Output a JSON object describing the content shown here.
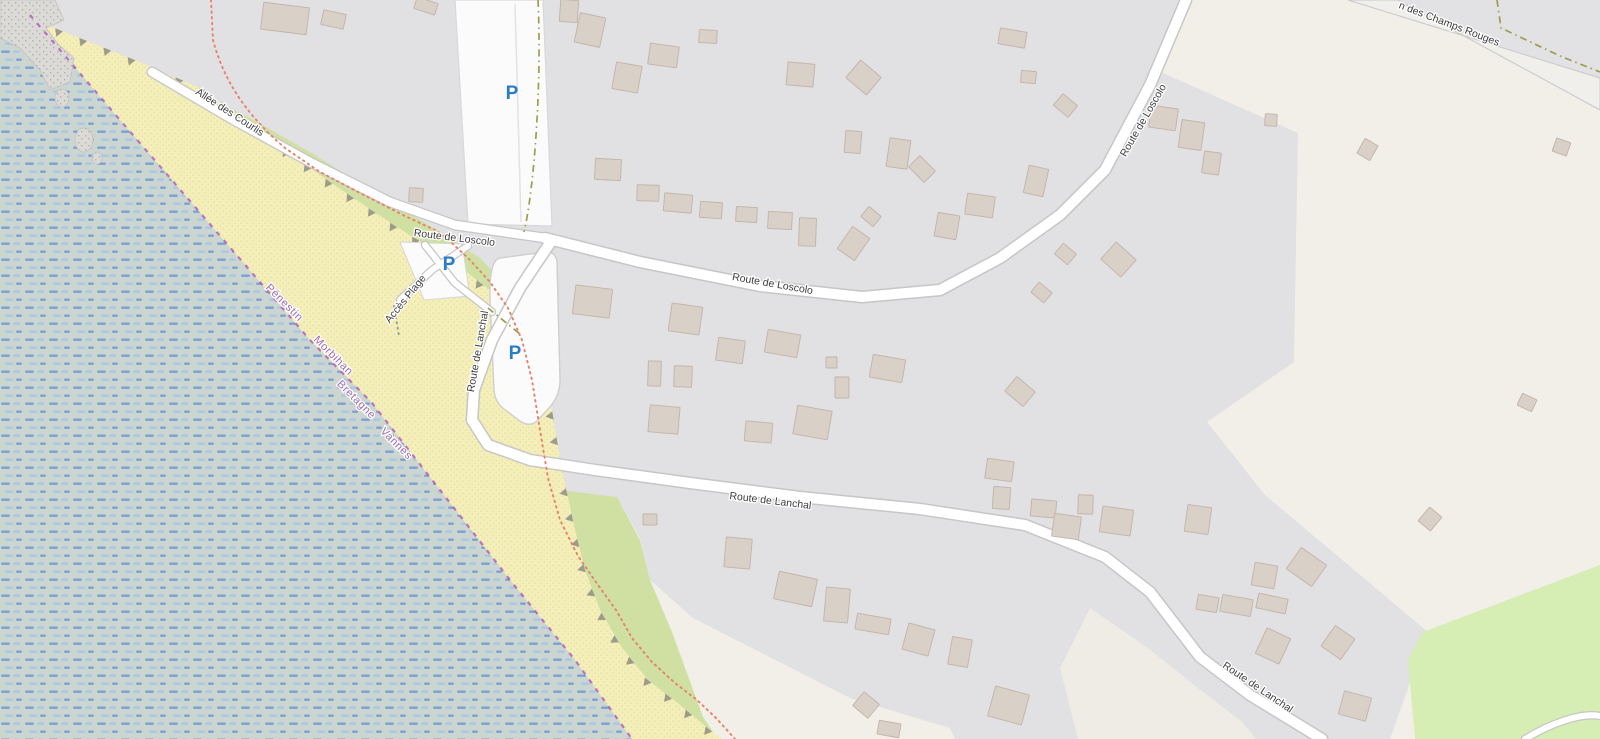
{
  "map": {
    "style": "openstreetmap-carto",
    "labels": {
      "allee_des_courlis": "Allée des Courlis",
      "route_de_loscolo": "Route de Loscolo",
      "route_de_lanchal": "Route de Lanchal",
      "acces_plage": "Accès Plage",
      "champs_rouges_partial": "n des Champs Rouges"
    },
    "places": [
      {
        "name": "Pénestin"
      },
      {
        "name": "Morbihan"
      },
      {
        "name": "Bretagne"
      },
      {
        "name": "Vannes"
      }
    ],
    "parking": {
      "symbol": "P",
      "color": "#2a7cc9",
      "markers": [
        {
          "x": 512,
          "y": 99
        },
        {
          "x": 449,
          "y": 270
        },
        {
          "x": 515,
          "y": 359
        }
      ]
    },
    "colors": {
      "land_cream": "#f2efe9",
      "residential_gray": "#e1e0e3",
      "water_base": "#ccd6d1",
      "water_dash_dark": "#7d9fd6",
      "water_dash_light": "#aac5e6",
      "beach_sand": "#f4eeb8",
      "beach_dot": "#d9cf93",
      "green_coastal": "#cfe0a2",
      "green_grass": "#d6edb4",
      "rock_gray": "#dbdad6",
      "building_fill": "#d9d0c8",
      "building_stroke": "#c2b3a8",
      "road_fill": "#ffffff",
      "road_casing": "#c6c6c6",
      "boundary_purple": "#b158b8",
      "admin_label_purple": "#9e6ab2",
      "footpath_red": "#e8816b",
      "track_olive": "#9d9d4e",
      "cliff_gray": "#8d8d84"
    },
    "features": {
      "buildings": [
        [
          262,
          5,
          46,
          27,
          7
        ],
        [
          322,
          12,
          23,
          15,
          12
        ],
        [
          415,
          0,
          22,
          12,
          18
        ],
        [
          560,
          0,
          18,
          22,
          4
        ],
        [
          577,
          15,
          26,
          30,
          12
        ],
        [
          649,
          45,
          29,
          21,
          8
        ],
        [
          614,
          64,
          26,
          27,
          10
        ],
        [
          699,
          30,
          18,
          13,
          3
        ],
        [
          787,
          63,
          27,
          23,
          5
        ],
        [
          850,
          66,
          27,
          23,
          40
        ],
        [
          999,
          30,
          27,
          16,
          10
        ],
        [
          1021,
          71,
          15,
          12,
          5
        ],
        [
          1056,
          98,
          19,
          15,
          40
        ],
        [
          595,
          159,
          26,
          21,
          3
        ],
        [
          637,
          185,
          22,
          16,
          2
        ],
        [
          664,
          194,
          28,
          18,
          5
        ],
        [
          700,
          202,
          22,
          16,
          4
        ],
        [
          736,
          207,
          21,
          15,
          3
        ],
        [
          768,
          212,
          24,
          17,
          3
        ],
        [
          799,
          218,
          17,
          28,
          2
        ],
        [
          843,
          230,
          21,
          27,
          35
        ],
        [
          863,
          210,
          16,
          13,
          40
        ],
        [
          936,
          214,
          22,
          24,
          10
        ],
        [
          888,
          139,
          21,
          29,
          8
        ],
        [
          845,
          131,
          16,
          22,
          5
        ],
        [
          911,
          161,
          22,
          16,
          45
        ],
        [
          966,
          195,
          28,
          21,
          8
        ],
        [
          1026,
          167,
          20,
          28,
          12
        ],
        [
          1057,
          247,
          17,
          14,
          40
        ],
        [
          1105,
          248,
          27,
          23,
          42
        ],
        [
          1033,
          286,
          17,
          13,
          40
        ],
        [
          409,
          188,
          14,
          14,
          3
        ],
        [
          1150,
          107,
          27,
          22,
          8
        ],
        [
          1180,
          121,
          23,
          28,
          8
        ],
        [
          1203,
          152,
          17,
          22,
          8
        ],
        [
          1265,
          114,
          12,
          12,
          3
        ],
        [
          1360,
          141,
          15,
          17,
          30
        ],
        [
          1554,
          140,
          15,
          14,
          20
        ],
        [
          574,
          287,
          37,
          29,
          7
        ],
        [
          670,
          305,
          31,
          28,
          8
        ],
        [
          766,
          332,
          33,
          23,
          10
        ],
        [
          717,
          339,
          27,
          23,
          8
        ],
        [
          648,
          361,
          13,
          25,
          2
        ],
        [
          674,
          366,
          18,
          21,
          2
        ],
        [
          826,
          357,
          11,
          11,
          0
        ],
        [
          835,
          377,
          14,
          21,
          0
        ],
        [
          871,
          357,
          33,
          23,
          10
        ],
        [
          649,
          406,
          30,
          27,
          5
        ],
        [
          745,
          422,
          27,
          20,
          5
        ],
        [
          795,
          408,
          35,
          29,
          10
        ],
        [
          1008,
          382,
          24,
          19,
          40
        ],
        [
          986,
          460,
          27,
          20,
          8
        ],
        [
          993,
          487,
          17,
          22,
          4
        ],
        [
          1031,
          500,
          25,
          17,
          5
        ],
        [
          1078,
          495,
          15,
          19,
          2
        ],
        [
          1053,
          515,
          27,
          23,
          8
        ],
        [
          1101,
          508,
          31,
          26,
          8
        ],
        [
          1186,
          506,
          24,
          27,
          8
        ],
        [
          1291,
          554,
          31,
          26,
          35
        ],
        [
          1253,
          564,
          23,
          23,
          10
        ],
        [
          1326,
          630,
          24,
          25,
          35
        ],
        [
          1422,
          510,
          16,
          18,
          40
        ],
        [
          1519,
          396,
          16,
          13,
          25
        ],
        [
          643,
          514,
          14,
          11,
          0
        ],
        [
          725,
          538,
          26,
          30,
          5
        ],
        [
          776,
          575,
          39,
          28,
          12
        ],
        [
          825,
          588,
          24,
          34,
          5
        ],
        [
          856,
          616,
          34,
          16,
          10
        ],
        [
          905,
          626,
          27,
          27,
          15
        ],
        [
          950,
          638,
          20,
          28,
          10
        ],
        [
          991,
          690,
          35,
          31,
          15
        ],
        [
          856,
          696,
          20,
          18,
          40
        ],
        [
          878,
          722,
          22,
          14,
          10
        ],
        [
          1197,
          596,
          21,
          15,
          10
        ],
        [
          1221,
          597,
          31,
          17,
          10
        ],
        [
          1257,
          596,
          30,
          15,
          12
        ],
        [
          1260,
          632,
          26,
          28,
          25
        ],
        [
          1341,
          694,
          28,
          24,
          15
        ]
      ]
    }
  }
}
